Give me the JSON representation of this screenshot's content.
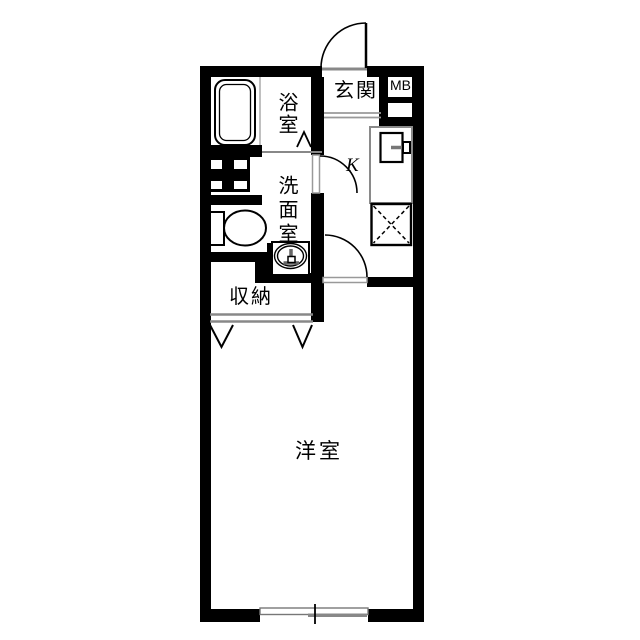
{
  "labels": {
    "entrance": "玄関",
    "meter_box": "MB",
    "bathroom": "浴室",
    "washroom": "洗面室",
    "kitchen": "K",
    "storage": "収納",
    "western_room": "洋室"
  },
  "fixtures": [
    "bathtub",
    "bath-door-marker",
    "washing-machine-pan",
    "toilet",
    "wash-basin",
    "kitchen-counter",
    "kitchen-sink",
    "refrigerator-space",
    "entrance-door",
    "kitchen-door",
    "room-door",
    "closet-sliding-doors",
    "closet-fold-markers",
    "sliding-window",
    "genkan-step"
  ],
  "colors": {
    "wall": "#000000",
    "fixture_line": "#888888",
    "outline": "#000000",
    "background": "#ffffff"
  }
}
